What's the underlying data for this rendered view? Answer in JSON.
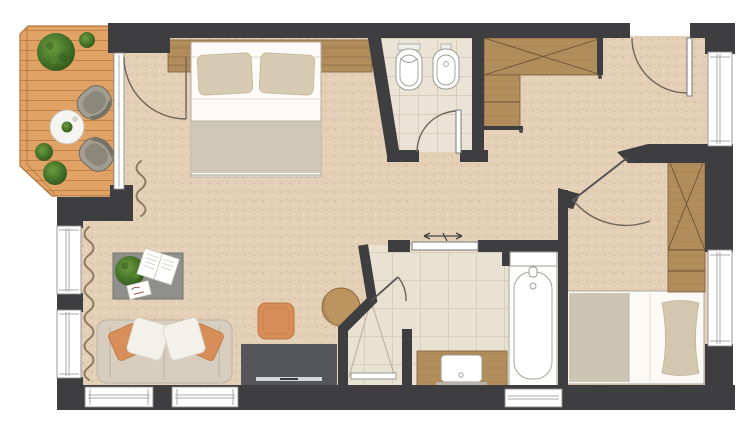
{
  "palette": {
    "wall": "#3e3e40",
    "carpet": "#e4cfb7",
    "carpet_dot_dark": "#d5b897",
    "carpet_dot_light": "#f1e2cd",
    "deck": "#e0a365",
    "deck_line": "#bf8148",
    "deck_edge": "#b5763d",
    "tile_s": "#ebe4d6",
    "tile_s_line": "#d7cdba",
    "tile_l": "#e9e1d2",
    "tile_l_line": "#d8cebc",
    "wood": "#b28e5d",
    "wood_line": "#8f6d3f",
    "white": "#ffffff",
    "fixture_stroke": "#9a9a95",
    "sofa": "#d7cec0",
    "sofa_line": "#bcb2a0",
    "pillow_orange": "#d88e58",
    "pillow_white": "#f3f1ea",
    "blanket": "#cfc7b6",
    "bed_pillow": "#d8cbb4",
    "gray_table": "#8f8f8c",
    "tv": "#54565a",
    "pouf": "#d88e58",
    "plant_d": "#2f5519",
    "plant_m": "#47762a",
    "plant_l": "#6f9c40",
    "chair": "#a29e92",
    "chair_dark": "#8b877b",
    "curtain": "#8d7b5e",
    "win": "#8f8f8f",
    "arc": "#6f665a",
    "side_table": "#bb9460"
  },
  "plan": {
    "rooms": [
      "balcony",
      "bedroom",
      "wc",
      "hall",
      "bathroom",
      "living-area",
      "second-bedroom"
    ],
    "furniture": [
      "double-bed",
      "headboard-panel",
      "toilet",
      "bidet",
      "wardrobe-x",
      "hall-cabinet",
      "sofa",
      "coffee-table",
      "ottoman-pouf",
      "tv-sideboard",
      "round-side-table",
      "shower",
      "vanity-sink",
      "bathtub",
      "single-bed",
      "tall-wardrobe",
      "outdoor-table",
      "outdoor-chair",
      "outdoor-chair",
      "plants",
      "curtains",
      "sliding-door",
      "hinged-doors",
      "windows"
    ]
  }
}
